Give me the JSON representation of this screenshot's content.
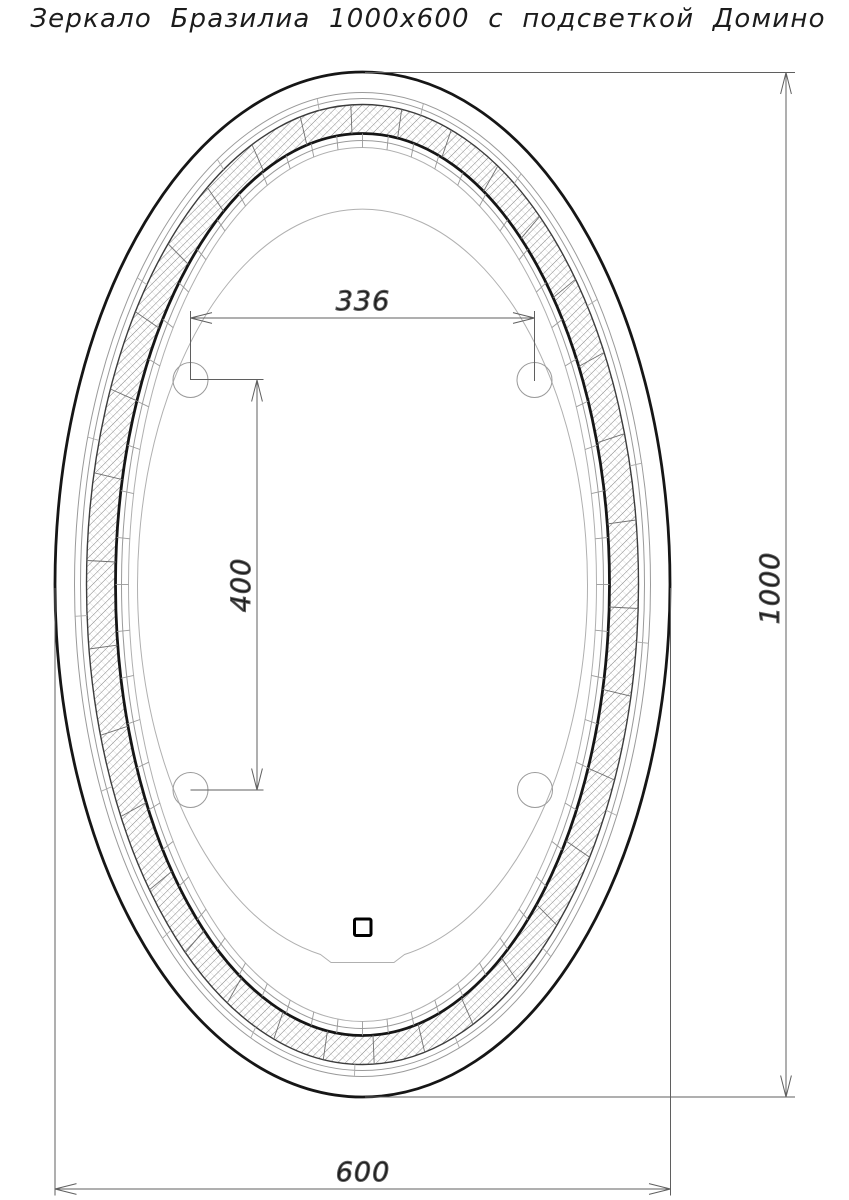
{
  "drawing": {
    "title": "Зеркало Бразилиа 1000х600 с подсветкой Домино",
    "dims": {
      "hole_spacing_horizontal": "336",
      "hole_spacing_vertical": "400",
      "mirror_height": "1000",
      "mirror_width": "600"
    },
    "colors": {
      "background": "#ffffff",
      "line_primary": "#161616",
      "line_thin": "#9a9a9a",
      "line_dimension": "#5f5f5f",
      "text": "#1c1c1c"
    }
  }
}
